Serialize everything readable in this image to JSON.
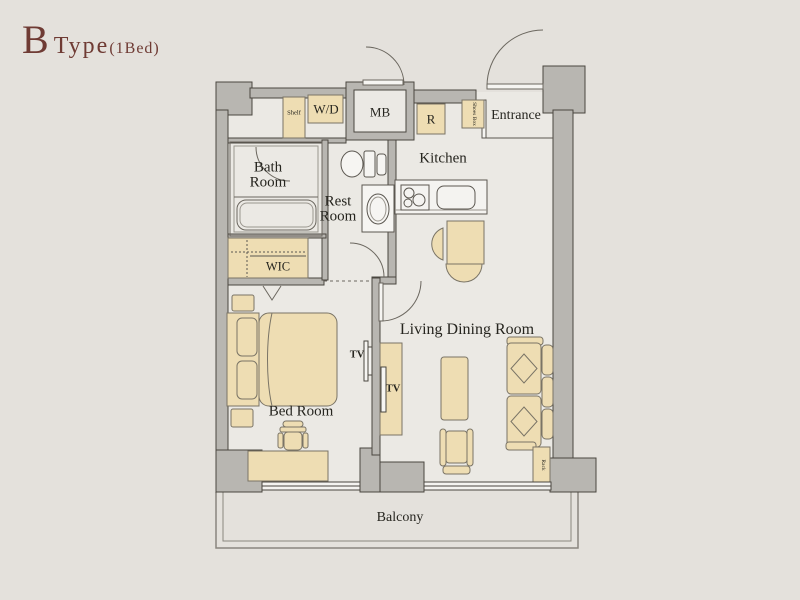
{
  "title": {
    "letter": "B",
    "type": "Type",
    "sub": "(1Bed)"
  },
  "rooms": {
    "bath": {
      "line1": "Bath",
      "line2": "Room"
    },
    "rest": {
      "line1": "Rest",
      "line2": "Room"
    },
    "kitchen": "Kitchen",
    "entrance": "Entrance",
    "living": "Living Dining Room",
    "bedroom": "Bed Room",
    "wic": "WIC",
    "balcony": "Balcony"
  },
  "fixtures": {
    "shelf": "Shelf",
    "washer_dryer": "W/D",
    "meter_box": "MB",
    "refrigerator": "R",
    "shoes_box": "Shoes Box",
    "tv_bedroom": "TV",
    "tv_living": "TV",
    "rack": "Rack"
  },
  "colors": {
    "background": "#e4e1dc",
    "floor": "#ebe9e4",
    "wall_fill": "#b8b6b1",
    "wall_stroke": "#4a463f",
    "furniture_tan": "#eeddb3",
    "fixture_white": "#f6f5f2",
    "title_text": "#6f3b34",
    "label_text": "#26251f"
  }
}
